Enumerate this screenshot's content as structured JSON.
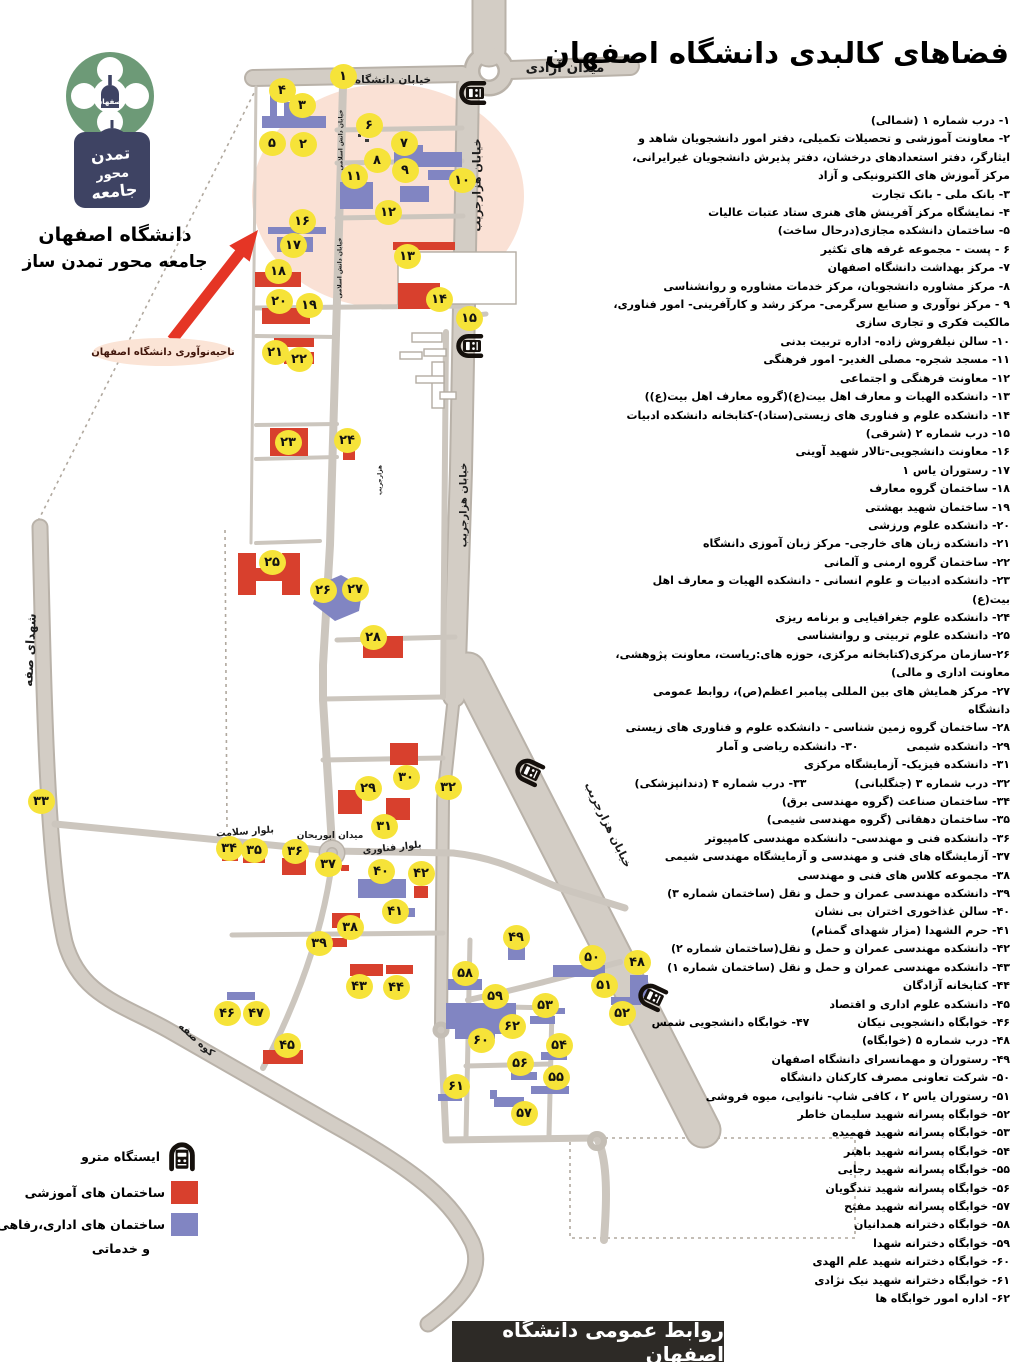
{
  "title": "فضاهای کالبدی دانشگاه اصفهان",
  "footer": "روابط عمومی دانشگاه اصفهان",
  "innovation_label": "ناحیه‌نوآوری دانشگاه اصفهان",
  "logo": {
    "name_line": "دانشگاه اصفهان",
    "slogan_line": "جامعه محور تمدن ساز",
    "emblem_text": "اصفهان",
    "plaque_line1": "تمدن",
    "plaque_line2": "محور",
    "plaque_line3": "جامعه"
  },
  "legend": {
    "metro": "ایستگاه مترو",
    "educational": "ساختمان های آموزشی",
    "admin_line1": "ساختمان های اداری،رفاهی",
    "admin_line2": "و خدماتی"
  },
  "colors": {
    "educational": "#d8402d",
    "administrative": "#8185c2",
    "marker": "#f6e339",
    "road": "#d3cdc5",
    "highlight": "#f8d9c9",
    "arrow": "#e53525"
  },
  "list": {
    "rows": [
      [
        "۱- درب شماره ۱ (شمالی)"
      ],
      [
        "۲- معاونت آموزشی و تحصیلات تکمیلی، دفتر امور دانشجویان شاهد و ایثارگر، دفتر استعدادهای درخشان، دفتر پذیرش دانشجویان غیرایرانی، مرکز آموزش های الکترونیکی و آزاد"
      ],
      [
        "۳- بانک ملی - بانک تجارت"
      ],
      [
        "۴- نمایشگاه مرکز آفرینش های هنری ستاد عتبات عالیات"
      ],
      [
        "۵- ساختمان دانشکده مجازی(درحال ساخت)"
      ],
      [
        "۶ - پست - مجموعه غرفه های تکثیر"
      ],
      [
        "۷- مرکز بهداشت دانشگاه اصفهان"
      ],
      [
        "۸- مرکز مشاوره دانشجویان، مرکز خدمات مشاوره و روانشناسی"
      ],
      [
        "۹ - مرکز نوآوری و صنایع سرگرمی- مرکز رشد و کارآفرینی- امور فناوری، مالکیت فکری و تجاری سازی"
      ],
      [
        "۱۰- سالن نیلفروش زاده- اداره تربیت بدنی"
      ],
      [
        "۱۱- مسجد شجره- مصلی الغدیر- امور فرهنگی"
      ],
      [
        "۱۲- معاونت فرهنگی و اجتماعی"
      ],
      [
        "۱۳- دانشکده الهیات و معارف اهل بیت(ع)(گروه معارف اهل بیت(ع))"
      ],
      [
        "۱۴- دانشکده علوم و فناوری های زیستی(ستاد)-کتابخانه دانشکده ادبیات"
      ],
      [
        "۱۵- درب شماره ۲ (شرقی)"
      ],
      [
        "۱۶- معاونت دانشجویی-تالار شهید آوینی"
      ],
      [
        "۱۷- رستوران یاس ۱"
      ],
      [
        "۱۸- ساختمان گروه معارف"
      ],
      [
        "۱۹- ساختمان شهید بهشتی"
      ],
      [
        "۲۰- دانشکده علوم ورزشی"
      ],
      [
        "۲۱- دانشکده زبان های خارجی- مرکز زبان آموزی دانشگاه"
      ],
      [
        "۲۲- ساختمان گروه ارمنی و آلمانی"
      ],
      [
        "۲۳- دانشکده ادبیات و علوم انسانی - دانشکده الهیات و معارف اهل بیت(ع)"
      ],
      [
        "۲۴- دانشکده علوم جغرافیایی و برنامه ریزی"
      ],
      [
        "۲۵- دانشکده علوم تربیتی و روانشناسی"
      ],
      [
        "۲۶-سازمان مرکزی(کتابخانه مرکزی، حوزه های:ریاست، معاونت پژوهشی، معاونت اداری و مالی)"
      ],
      [
        "۲۷- مرکز همایش های بین المللی پیامبر اعظم(ص)، روابط عمومی دانشگاه"
      ],
      [
        "۲۸- ساختمان گروه زمین شناسی - دانشکده علوم و فناوری های زیستی"
      ],
      [
        "۲۹- دانشکده شیمی",
        "۳۰- دانشکده ریاضی و آمار"
      ],
      [
        "۳۱- دانشکده فیزیک- آزمایشگاه مرکزی"
      ],
      [
        "۳۲- درب شماره ۳ (جنگلبانی)",
        "۳۳- درب شماره ۴ (دندانپزشکی)"
      ],
      [
        "۳۴- ساختمان صناعت (گروه مهندسی برق)"
      ],
      [
        "۳۵- ساختمان دهقانی (گروه مهندسی شیمی)"
      ],
      [
        "۳۶- دانشکده فنی و مهندسی- دانشکده مهندسی کامپیوتر"
      ],
      [
        "۳۷- آزمایشگاه های فنی و مهندسی و آزمایشگاه مهندسی شیمی"
      ],
      [
        "۳۸- مجموعه کلاس های فنی و مهندسی"
      ],
      [
        "۳۹- دانشکده مهندسی عمران و حمل و نقل (ساختمان شماره ۳)"
      ],
      [
        "۴۰- سالن غذاخوری اختران بی نشان"
      ],
      [
        "۴۱- حرم الشهدا (مزار شهدای گمنام)"
      ],
      [
        "۴۲- دانشکده مهندسی عمران و حمل و نقل(ساختمان شماره ۲)"
      ],
      [
        "۴۳- دانشکده مهندسی عمران و حمل و نقل (ساختمان شماره ۱)"
      ],
      [
        "۴۴- کتابخانه آزادگان"
      ],
      [
        "۴۵- دانشکده علوم اداری و اقتصاد"
      ],
      [
        "۴۶- خوابگاه دانشجویی نیکان",
        "۴۷- خوابگاه دانشجویی شمس"
      ],
      [
        "۴۸- درب شماره ۵ (خوابگاه)"
      ],
      [
        "۴۹- رستوران و مهمانسرای دانشگاه اصفهان"
      ],
      [
        "۵۰- شرکت تعاونی مصرف کارکنان دانشگاه"
      ],
      [
        "۵۱- رستوران یاس ۲ ، کافی شاپ- نانوایی، میوه فروشی"
      ],
      [
        "۵۲- خوابگاه پسرانه شهید سلیمان خاطر"
      ],
      [
        "۵۳- خوابگاه پسرانه شهید فهمیده"
      ],
      [
        "۵۴- خوابگاه پسرانه شهید باهنر"
      ],
      [
        "۵۵- خوابگاه پسرانه شهید رجایی"
      ],
      [
        "۵۶- خوابگاه پسرانه شهید تندگویان"
      ],
      [
        "۵۷- خوابگاه پسرانه شهید مفتح"
      ],
      [
        "۵۸- خوابگاه دخترانه همدانیان"
      ],
      [
        "۵۹- خوابگاه دخترانه شهدا"
      ],
      [
        "۶۰- خوابگاه دخترانه شهید علم الهدی"
      ],
      [
        "۶۱- خوابگاه دخترانه شهید نیک نژادی"
      ],
      [
        "۶۲- اداره امور خوابگاه ها"
      ]
    ]
  },
  "map": {
    "road_labels": [
      {
        "t": "خیابان دانشگاه",
        "x": 393,
        "y": 80,
        "r": 0,
        "s": 10.5
      },
      {
        "t": "میدان آزادی",
        "x": 565,
        "y": 68,
        "r": 0,
        "s": 13.5
      },
      {
        "t": "خیابان هزارجریب",
        "x": 477,
        "y": 185,
        "r": -90,
        "s": 11
      },
      {
        "t": "خیابان هزارجریب",
        "x": 464,
        "y": 505,
        "r": -90,
        "s": 10
      },
      {
        "t": "خیابان هزارجریب",
        "x": 608,
        "y": 825,
        "r": 64,
        "s": 11
      },
      {
        "t": "شهدای صفه",
        "x": 30,
        "y": 650,
        "r": -87,
        "s": 12
      },
      {
        "t": "میدان ابوریحان",
        "x": 330,
        "y": 836,
        "r": 0,
        "s": 9
      },
      {
        "t": "بلوار فناوری",
        "x": 392,
        "y": 848,
        "r": -6,
        "s": 9.5
      },
      {
        "t": "بلوار سلامت",
        "x": 245,
        "y": 832,
        "r": -4,
        "s": 9.5
      },
      {
        "t": "کوه صفه",
        "x": 196,
        "y": 1040,
        "r": 42,
        "s": 10
      },
      {
        "t": "خیابان دانش اسلامی",
        "x": 341,
        "y": 140,
        "r": -90,
        "s": 6
      },
      {
        "t": "خیابان دانش اسلامی",
        "x": 340,
        "y": 268,
        "r": -90,
        "s": 6
      },
      {
        "t": "هزارجریب",
        "x": 380,
        "y": 480,
        "r": -90,
        "s": 6
      }
    ],
    "markers": [
      {
        "n": "۱",
        "x": 343,
        "y": 76
      },
      {
        "n": "۲",
        "x": 303,
        "y": 144
      },
      {
        "n": "۳",
        "x": 302,
        "y": 105
      },
      {
        "n": "۴",
        "x": 282,
        "y": 90
      },
      {
        "n": "۵",
        "x": 272,
        "y": 143
      },
      {
        "n": "۶",
        "x": 369,
        "y": 125
      },
      {
        "n": "۷",
        "x": 404,
        "y": 143
      },
      {
        "n": "۸",
        "x": 377,
        "y": 160
      },
      {
        "n": "۹",
        "x": 405,
        "y": 170
      },
      {
        "n": "۱۰",
        "x": 462,
        "y": 180
      },
      {
        "n": "۱۱",
        "x": 354,
        "y": 176
      },
      {
        "n": "۱۲",
        "x": 388,
        "y": 212
      },
      {
        "n": "۱۳",
        "x": 407,
        "y": 256
      },
      {
        "n": "۱۴",
        "x": 439,
        "y": 299
      },
      {
        "n": "۱۵",
        "x": 469,
        "y": 318
      },
      {
        "n": "۱۶",
        "x": 302,
        "y": 221
      },
      {
        "n": "۱۷",
        "x": 293,
        "y": 245
      },
      {
        "n": "۱۸",
        "x": 278,
        "y": 271
      },
      {
        "n": "۱۹",
        "x": 309,
        "y": 305
      },
      {
        "n": "۲۰",
        "x": 279,
        "y": 301
      },
      {
        "n": "۲۱",
        "x": 275,
        "y": 352
      },
      {
        "n": "۲۲",
        "x": 299,
        "y": 359
      },
      {
        "n": "۲۳",
        "x": 288,
        "y": 442
      },
      {
        "n": "۲۴",
        "x": 347,
        "y": 440
      },
      {
        "n": "۲۵",
        "x": 272,
        "y": 562
      },
      {
        "n": "۲۶",
        "x": 323,
        "y": 590
      },
      {
        "n": "۲۷",
        "x": 355,
        "y": 589
      },
      {
        "n": "۲۸",
        "x": 373,
        "y": 637
      },
      {
        "n": "۲۹",
        "x": 368,
        "y": 788
      },
      {
        "n": "۳۰",
        "x": 406,
        "y": 777
      },
      {
        "n": "۳۱",
        "x": 384,
        "y": 826
      },
      {
        "n": "۳۲",
        "x": 448,
        "y": 787
      },
      {
        "n": "۳۳",
        "x": 41,
        "y": 801
      },
      {
        "n": "۳۴",
        "x": 229,
        "y": 848
      },
      {
        "n": "۳۵",
        "x": 254,
        "y": 850
      },
      {
        "n": "۳۶",
        "x": 295,
        "y": 851
      },
      {
        "n": "۳۷",
        "x": 328,
        "y": 864
      },
      {
        "n": "۳۸",
        "x": 350,
        "y": 927
      },
      {
        "n": "۳۹",
        "x": 319,
        "y": 943
      },
      {
        "n": "۴۰",
        "x": 381,
        "y": 871
      },
      {
        "n": "۴۱",
        "x": 395,
        "y": 911
      },
      {
        "n": "۴۲",
        "x": 421,
        "y": 873
      },
      {
        "n": "۴۳",
        "x": 359,
        "y": 986
      },
      {
        "n": "۴۴",
        "x": 396,
        "y": 987
      },
      {
        "n": "۴۵",
        "x": 287,
        "y": 1045
      },
      {
        "n": "۴۶",
        "x": 227,
        "y": 1013
      },
      {
        "n": "۴۷",
        "x": 256,
        "y": 1013
      },
      {
        "n": "۴۸",
        "x": 637,
        "y": 962
      },
      {
        "n": "۴۹",
        "x": 516,
        "y": 937
      },
      {
        "n": "۵۰",
        "x": 592,
        "y": 957
      },
      {
        "n": "۵۱",
        "x": 604,
        "y": 985
      },
      {
        "n": "۵۲",
        "x": 622,
        "y": 1013
      },
      {
        "n": "۵۳",
        "x": 545,
        "y": 1005
      },
      {
        "n": "۵۴",
        "x": 559,
        "y": 1045
      },
      {
        "n": "۵۵",
        "x": 556,
        "y": 1077
      },
      {
        "n": "۵۶",
        "x": 520,
        "y": 1063
      },
      {
        "n": "۵۷",
        "x": 524,
        "y": 1113
      },
      {
        "n": "۵۸",
        "x": 465,
        "y": 973
      },
      {
        "n": "۵۹",
        "x": 495,
        "y": 996
      },
      {
        "n": "۶۰",
        "x": 481,
        "y": 1040
      },
      {
        "n": "۶۱",
        "x": 456,
        "y": 1086
      },
      {
        "n": "۶۲",
        "x": 512,
        "y": 1026
      }
    ],
    "metro_stations": [
      {
        "x": 472,
        "y": 93,
        "r": -90
      },
      {
        "x": 469,
        "y": 346,
        "r": -90
      },
      {
        "x": 528,
        "y": 771,
        "r": -65
      },
      {
        "x": 651,
        "y": 996,
        "r": -65
      }
    ],
    "buildings": [
      {
        "t": "a",
        "x": 262,
        "y": 116,
        "w": 64,
        "h": 12
      },
      {
        "t": "a",
        "x": 284,
        "y": 102,
        "w": 18,
        "h": 14
      },
      {
        "t": "a",
        "x": 270,
        "y": 92,
        "w": 7,
        "h": 28
      },
      {
        "t": "a",
        "x": 394,
        "y": 152,
        "w": 68,
        "h": 15
      },
      {
        "t": "a",
        "x": 407,
        "y": 145,
        "w": 16,
        "h": 7
      },
      {
        "t": "a",
        "x": 428,
        "y": 170,
        "w": 34,
        "h": 10
      },
      {
        "t": "a",
        "x": 340,
        "y": 182,
        "w": 33,
        "h": 27
      },
      {
        "t": "a",
        "x": 400,
        "y": 186,
        "w": 29,
        "h": 16
      },
      {
        "t": "a",
        "x": 268,
        "y": 227,
        "w": 58,
        "h": 7
      },
      {
        "t": "a",
        "x": 277,
        "y": 237,
        "w": 36,
        "h": 15
      },
      {
        "t": "e",
        "x": 393,
        "y": 242,
        "w": 62,
        "h": 8
      },
      {
        "t": "o",
        "x": 398,
        "y": 252,
        "w": 118,
        "h": 52
      },
      {
        "t": "e",
        "x": 255,
        "y": 272,
        "w": 46,
        "h": 15
      },
      {
        "t": "e",
        "x": 398,
        "y": 283,
        "w": 42,
        "h": 26
      },
      {
        "t": "e",
        "x": 262,
        "y": 308,
        "w": 48,
        "h": 16
      },
      {
        "t": "e",
        "x": 274,
        "y": 338,
        "w": 40,
        "h": 9
      },
      {
        "t": "e",
        "x": 284,
        "y": 352,
        "w": 30,
        "h": 12
      },
      {
        "t": "e",
        "x": 270,
        "y": 428,
        "w": 38,
        "h": 28
      },
      {
        "t": "e",
        "x": 343,
        "y": 450,
        "w": 12,
        "h": 10
      },
      {
        "t": "e",
        "x": 238,
        "y": 553,
        "w": 18,
        "h": 42
      },
      {
        "t": "e",
        "x": 282,
        "y": 553,
        "w": 18,
        "h": 42
      },
      {
        "t": "e",
        "x": 252,
        "y": 568,
        "w": 34,
        "h": 13
      },
      {
        "t": "e",
        "x": 363,
        "y": 636,
        "w": 40,
        "h": 22
      },
      {
        "t": "e",
        "x": 338,
        "y": 790,
        "w": 24,
        "h": 24
      },
      {
        "t": "e",
        "x": 390,
        "y": 743,
        "w": 28,
        "h": 22
      },
      {
        "t": "e",
        "x": 386,
        "y": 798,
        "w": 24,
        "h": 22
      },
      {
        "t": "e",
        "x": 222,
        "y": 852,
        "w": 16,
        "h": 9
      },
      {
        "t": "e",
        "x": 243,
        "y": 856,
        "w": 22,
        "h": 7
      },
      {
        "t": "e",
        "x": 282,
        "y": 858,
        "w": 24,
        "h": 17
      },
      {
        "t": "e",
        "x": 329,
        "y": 860,
        "w": 9,
        "h": 8
      },
      {
        "t": "e",
        "x": 341,
        "y": 865,
        "w": 8,
        "h": 6
      },
      {
        "t": "a",
        "x": 358,
        "y": 879,
        "w": 48,
        "h": 19
      },
      {
        "t": "e",
        "x": 414,
        "y": 886,
        "w": 14,
        "h": 12
      },
      {
        "t": "a",
        "x": 404,
        "y": 908,
        "w": 11,
        "h": 9
      },
      {
        "t": "e",
        "x": 332,
        "y": 913,
        "w": 28,
        "h": 15
      },
      {
        "t": "e",
        "x": 327,
        "y": 938,
        "w": 20,
        "h": 9
      },
      {
        "t": "e",
        "x": 350,
        "y": 964,
        "w": 33,
        "h": 12
      },
      {
        "t": "e",
        "x": 386,
        "y": 965,
        "w": 27,
        "h": 9
      },
      {
        "t": "a",
        "x": 227,
        "y": 992,
        "w": 28,
        "h": 8
      },
      {
        "t": "e",
        "x": 263,
        "y": 1050,
        "w": 40,
        "h": 14
      },
      {
        "t": "a",
        "x": 508,
        "y": 946,
        "w": 17,
        "h": 14
      },
      {
        "t": "a",
        "x": 553,
        "y": 965,
        "w": 52,
        "h": 12
      },
      {
        "t": "a",
        "x": 630,
        "y": 975,
        "w": 18,
        "h": 22
      },
      {
        "t": "a",
        "x": 611,
        "y": 997,
        "w": 30,
        "h": 8
      },
      {
        "t": "a",
        "x": 448,
        "y": 979,
        "w": 34,
        "h": 11
      },
      {
        "t": "a",
        "x": 446,
        "y": 1003,
        "w": 70,
        "h": 26
      },
      {
        "t": "a",
        "x": 488,
        "y": 1000,
        "w": 14,
        "h": 34
      },
      {
        "t": "a",
        "x": 455,
        "y": 1029,
        "w": 40,
        "h": 10
      },
      {
        "t": "a",
        "x": 545,
        "y": 1008,
        "w": 20,
        "h": 6
      },
      {
        "t": "a",
        "x": 530,
        "y": 1016,
        "w": 25,
        "h": 8
      },
      {
        "t": "a",
        "x": 541,
        "y": 1052,
        "w": 26,
        "h": 8
      },
      {
        "t": "a",
        "x": 511,
        "y": 1072,
        "w": 26,
        "h": 8
      },
      {
        "t": "a",
        "x": 531,
        "y": 1086,
        "w": 38,
        "h": 8
      },
      {
        "t": "a",
        "x": 438,
        "y": 1094,
        "w": 24,
        "h": 7
      },
      {
        "t": "a",
        "x": 494,
        "y": 1097,
        "w": 30,
        "h": 10
      },
      {
        "t": "a",
        "x": 490,
        "y": 1090,
        "w": 7,
        "h": 9
      },
      {
        "t": "o",
        "x": 412,
        "y": 333,
        "w": 30,
        "h": 9
      },
      {
        "t": "o",
        "x": 400,
        "y": 352,
        "w": 22,
        "h": 7
      },
      {
        "t": "o",
        "x": 424,
        "y": 349,
        "w": 22,
        "h": 7
      },
      {
        "t": "o",
        "x": 432,
        "y": 362,
        "w": 12,
        "h": 46
      },
      {
        "t": "o",
        "x": 416,
        "y": 376,
        "w": 28,
        "h": 7
      },
      {
        "t": "o",
        "x": 440,
        "y": 392,
        "w": 16,
        "h": 7
      },
      {
        "t": "d",
        "x": 359,
        "y": 127,
        "w": 4,
        "h": 4
      },
      {
        "t": "d",
        "x": 366,
        "y": 132,
        "w": 4,
        "h": 4
      },
      {
        "t": "d",
        "x": 358,
        "y": 134,
        "w": 3,
        "h": 3
      },
      {
        "t": "d",
        "x": 365,
        "y": 139,
        "w": 4,
        "h": 3
      }
    ]
  }
}
